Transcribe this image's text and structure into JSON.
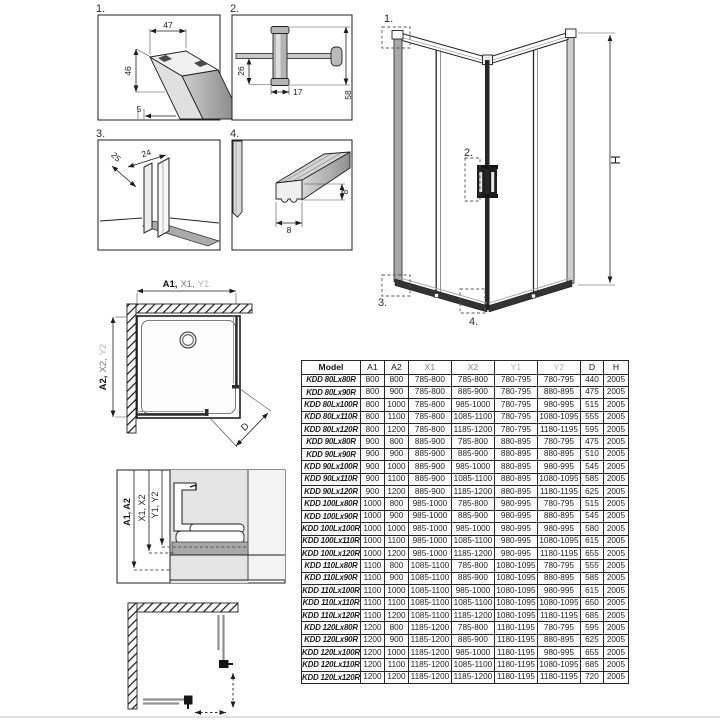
{
  "colors": {
    "line": "#1c1c1c",
    "mid_gray": "#7d7d7d",
    "light_gray": "#b3b3b3",
    "frame_gray": "#a8a8a8",
    "section_bg": "#e4e4e4",
    "track_bar": "#a8a8a8"
  },
  "drawings": {
    "detail1": {
      "label": "1.",
      "dim_width": "47",
      "dim_height": "46",
      "dim_gap": "5"
    },
    "detail2": {
      "label": "2.",
      "dim_left": "26",
      "dim_width": "17",
      "dim_height": "58"
    },
    "detail3": {
      "label": "3.",
      "dim_depth": "25",
      "dim_width": "24"
    },
    "detail4": {
      "label": "4.",
      "dim_height": "8",
      "dim_width": "8"
    },
    "main": {
      "callout1": "1.",
      "callout2": "2.",
      "callout3": "3.",
      "callout4": "4.",
      "height": "H"
    },
    "plan": {
      "w1": "A1,",
      "w2": "X1,",
      "w3": "Y1",
      "h1": "A2,",
      "h2": "X2,",
      "h3": "Y2",
      "diagonal": "D"
    },
    "section": {
      "a": "A1, A2",
      "x": "X1, X2",
      "y": "Y1, Y2"
    }
  },
  "table": {
    "headers": [
      "Model",
      "A1",
      "A2",
      "X1",
      "X2",
      "Y1",
      "Y2",
      "D",
      "H"
    ],
    "rows": [
      [
        "KDD 80Lx80R",
        "800",
        "800",
        "785-800",
        "785-800",
        "780-795",
        "780-795",
        "440",
        "2005"
      ],
      [
        "KDD 80Lx90R",
        "800",
        "900",
        "785-800",
        "885-900",
        "780-795",
        "880-895",
        "475",
        "2005"
      ],
      [
        "KDD 80Lx100R",
        "800",
        "1000",
        "785-800",
        "985-1000",
        "780-795",
        "980-995",
        "515",
        "2005"
      ],
      [
        "KDD 80Lx110R",
        "800",
        "1100",
        "785-800",
        "1085-1100",
        "780-795",
        "1080-1095",
        "555",
        "2005"
      ],
      [
        "KDD 80Lx120R",
        "800",
        "1200",
        "785-800",
        "1185-1200",
        "780-795",
        "1180-1195",
        "595",
        "2005"
      ],
      [
        "KDD 90Lx80R",
        "900",
        "800",
        "885-900",
        "785-800",
        "880-895",
        "780-795",
        "475",
        "2005"
      ],
      [
        "KDD 90Lx90R",
        "900",
        "900",
        "885-900",
        "885-900",
        "880-895",
        "880-895",
        "510",
        "2005"
      ],
      [
        "KDD 90Lx100R",
        "900",
        "1000",
        "885-900",
        "985-1000",
        "880-895",
        "980-995",
        "545",
        "2005"
      ],
      [
        "KDD 90Lx110R",
        "900",
        "1100",
        "885-900",
        "1085-1100",
        "880-895",
        "1080-1095",
        "585",
        "2005"
      ],
      [
        "KDD 90Lx120R",
        "900",
        "1200",
        "885-900",
        "1185-1200",
        "880-895",
        "1180-1195",
        "625",
        "2005"
      ],
      [
        "KDD 100Lx80R",
        "1000",
        "800",
        "985-1000",
        "785-800",
        "980-995",
        "780-795",
        "515",
        "2005"
      ],
      [
        "KDD 100Lx90R",
        "1000",
        "900",
        "985-1000",
        "885-900",
        "980-995",
        "880-895",
        "545",
        "2005"
      ],
      [
        "KDD 100Lx100R",
        "1000",
        "1000",
        "985-1000",
        "985-1000",
        "980-995",
        "980-995",
        "580",
        "2005"
      ],
      [
        "KDD 100Lx110R",
        "1000",
        "1100",
        "985-1000",
        "1085-1100",
        "980-995",
        "1080-1095",
        "615",
        "2005"
      ],
      [
        "KDD 100Lx120R",
        "1000",
        "1200",
        "985-1000",
        "1185-1200",
        "980-995",
        "1180-1195",
        "655",
        "2005"
      ],
      [
        "KDD 110Lx80R",
        "1100",
        "800",
        "1085-1100",
        "785-800",
        "1080-1095",
        "780-795",
        "555",
        "2005"
      ],
      [
        "KDD 110Lx90R",
        "1100",
        "900",
        "1085-1100",
        "885-900",
        "1080-1095",
        "880-895",
        "585",
        "2005"
      ],
      [
        "KDD 110Lx100R",
        "1100",
        "1000",
        "1085-1100",
        "985-1000",
        "1080-1095",
        "980-995",
        "615",
        "2005"
      ],
      [
        "KDD 110Lx110R",
        "1100",
        "1100",
        "1085-1100",
        "1085-1100",
        "1080-1095",
        "1080-1095",
        "650",
        "2005"
      ],
      [
        "KDD 110Lx120R",
        "1100",
        "1200",
        "1085-1100",
        "1185-1200",
        "1080-1095",
        "1180-1195",
        "685",
        "2005"
      ],
      [
        "KDD 120Lx80R",
        "1200",
        "800",
        "1185-1200",
        "785-800",
        "1180-1195",
        "780-795",
        "595",
        "2005"
      ],
      [
        "KDD 120Lx90R",
        "1200",
        "900",
        "1185-1200",
        "885-900",
        "1180-1195",
        "880-895",
        "625",
        "2005"
      ],
      [
        "KDD 120Lx100R",
        "1200",
        "1000",
        "1185-1200",
        "985-1000",
        "1180-1195",
        "980-995",
        "655",
        "2005"
      ],
      [
        "KDD 120Lx110R",
        "1200",
        "1100",
        "1185-1200",
        "1085-1100",
        "1180-1195",
        "1080-1095",
        "685",
        "2005"
      ],
      [
        "KDD 120Lx120R",
        "1200",
        "1200",
        "1185-1200",
        "1185-1200",
        "1180-1195",
        "1180-1195",
        "720",
        "2005"
      ]
    ]
  }
}
